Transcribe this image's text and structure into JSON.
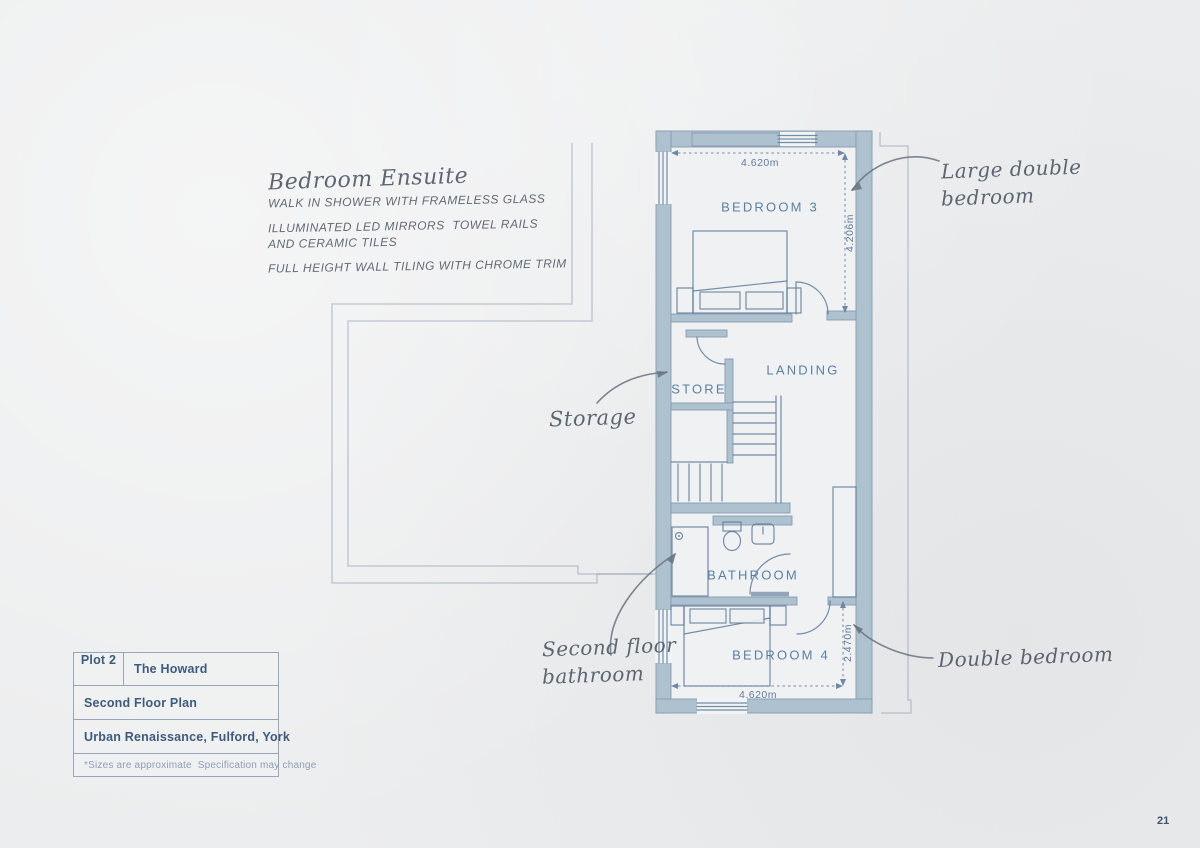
{
  "page": {
    "number": "21"
  },
  "annotations": {
    "ensuite_title": "Bedroom Ensuite",
    "ensuite_line1": "WALK IN SHOWER WITH FRAMELESS GLASS",
    "ensuite_line2": "ILLUMINATED LED MIRRORS  TOWEL RAILS",
    "ensuite_line3": "AND CERAMIC TILES",
    "ensuite_line4": "FULL HEIGHT WALL TILING WITH CHROME TRIM",
    "storage": "Storage",
    "large_double_line1": "Large double",
    "large_double_line2": "bedroom",
    "second_floor_line1": "Second floor",
    "second_floor_line2": "bathroom",
    "double_bedroom": "Double bedroom"
  },
  "rooms": {
    "bedroom3": "BEDROOM 3",
    "landing": "LANDING",
    "store": "STORE",
    "bathroom": "BATHROOM",
    "bedroom4": "BEDROOM 4"
  },
  "dimensions": {
    "bedroom3_width": "4.620m",
    "bedroom3_depth": "4.206m",
    "bedroom4_depth": "2.470m",
    "bedroom4_width": "4.620m"
  },
  "title_block": {
    "plot": "Plot 2",
    "house_name": "The Howard",
    "floor": "Second Floor Plan",
    "development": "Urban Renaissance, Fulford, York",
    "disclaimer": "*Sizes are approximate  Specification may change"
  },
  "colors": {
    "paper": "#ecedee",
    "wall": "#aec1cf",
    "walledge": "#849cb0",
    "line": "#5d7b99",
    "faint": "#8e9cae",
    "label": "#5b80a4",
    "dim": "#5f7d9b",
    "hand": "#4d5864",
    "arrow": "#68727f",
    "titletext": "#3d5b7e",
    "titlemuted": "#8fa0b6",
    "border": "#97a6ba",
    "pagenum": "#3d5570"
  }
}
